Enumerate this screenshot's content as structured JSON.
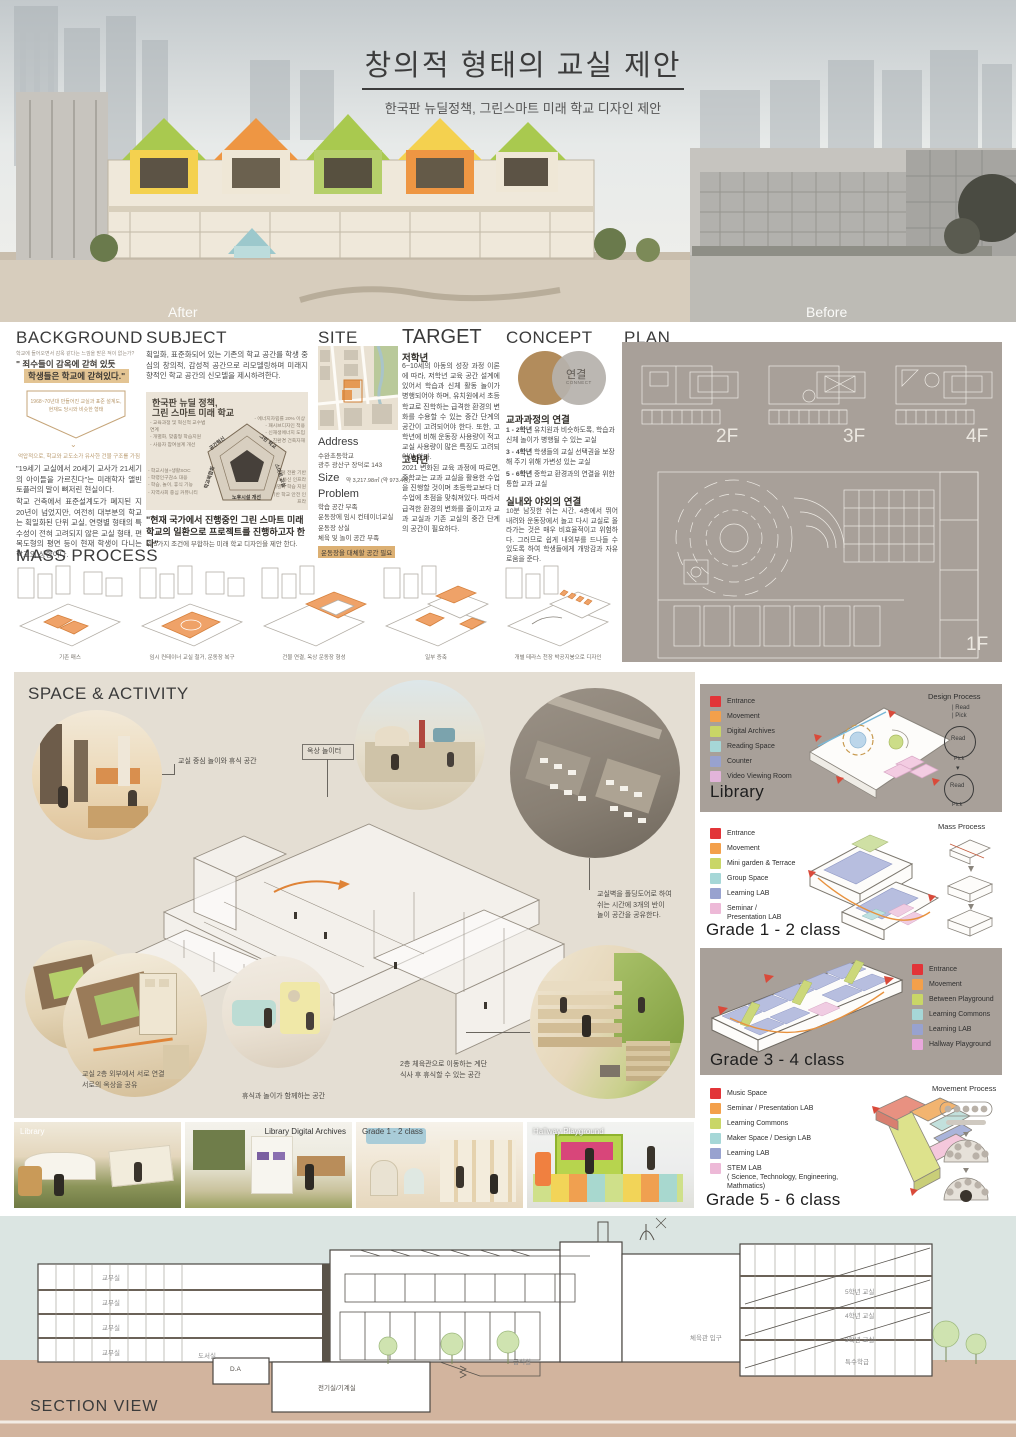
{
  "header": {
    "title": "창의적 형태의 교실 제안",
    "subtitle": "한국판 뉴딜정책, 그린스마트 미래 학교 디자인 제안",
    "after_label": "After",
    "before_label": "Before"
  },
  "background": {
    "heading": "BACKGROUND",
    "tagline": "학교에 들어오면서 감옥 같다는 느낌을 받은 적이 없는가?",
    "quote_line1": "\" 죄수들이 감옥에 갇혀 있듯",
    "quote_line2": "학생들은 학교에 갇혀있다.\"",
    "shield_line1": "1968~70년대 만들어진 교실과 표준 설계도,",
    "shield_line2": "현재도 당시와 비슷한 형태",
    "shield_caption": "억압적으로, 학교와 교도소가 유사한 건물 구조를 가짐",
    "para1": "\"19세기 교실에서 20세기 교사가 21세기의 아이들을 가르친다\"는 미래학자 앨빈 토플러의 말이 뼈저린 현실이다.",
    "para2": "학교 건축에서 표준설계도가 폐지된 지 20년이 넘었지만, 여전히 대부분의 학교는 획일화된 단위 교실, 연령별 형태의 특수성이 전혀 고려되지 않은 교실 형태, 편복도형의 평면 등이 현재 학생이 다니는 학교의 상황이다."
  },
  "subject": {
    "heading": "SUBJECT",
    "intro": "획일화, 표준화되어 있는 기존의 학교 공간를 학생 중심의 창의적, 감성적 공간으로 리모델링하며 미래지향적인 학교 공간의 신모델을 제시하려한다.",
    "diagram_title_line1": "한국판 뉴딜 정책,",
    "diagram_title_line2": "그린 스마트 미래 학교",
    "left_top": [
      "- 교육과정 및 혁신적 교수법 연계",
      "- 개별화, 맞춤형 학습지원",
      "- 사용자 참여설계 개선"
    ],
    "right_top": [
      "- 에너지자립률 20% 이상",
      "- 패시브디자인 적용",
      "- 신재생에너지 도입",
      "- 친환경 건축자재"
    ],
    "left_bottom": [
      "- 학교시설+생활SOC",
      "- 학령인구감소 대응",
      "- 학습, 놀이, 휴식 기능",
      "- 지역사회 중심 커뮤니티"
    ],
    "right_bottom": [
      "- 디지털 전환 기반",
      "- 정보통신 인프라",
      "- 개별화 학습 지원",
      "- 지능정보기반 학교 안전 인프라"
    ],
    "pentagon": [
      "공간혁신",
      "그린 학교",
      "스마트 교실",
      "노후시설 개선",
      "학교복합화"
    ],
    "statement": "\"현재 국가에서 진행중인 그린 스마트 미래학교의 일환으로 프로젝트를 진행하고자 한다\"",
    "statement_note": "위 5가지 조건에 부합하는 미래 학교 디자인을 제안 한다."
  },
  "site": {
    "heading": "SITE",
    "address_label": "Address",
    "address_line1": "수완초등학교",
    "address_line2": "광주 광산구 장덕로 143",
    "size_label": "Size",
    "size_value": "약 3,217.98㎡ (약 973.4평)",
    "problem_label": "Problem",
    "problems": [
      "학습 공간 부족",
      "운동장에 임시 컨테이너교실",
      "운동장 상실",
      "체육 및 놀이 공간 부족"
    ],
    "problem_highlight": "운동장을 대체할 공간 필요"
  },
  "target": {
    "heading": "TARGET",
    "low_label": "저학년",
    "low_text": "6~10세의 아동의 성장 과정 이론에 따라, 저학년 교육 공간 설계에 있어서 학습과 신체 활동 놀이가 병행되어야 하며, 유치원에서 초등학교로 진학하는 급격한 환경의 변화를 수용할 수 있는 중간 단계의 공간이 고려되어야 한다. 또한, 고학년에 비해 운동장 사용량이 적고 교실 사용량이 많은 특징도 고려되어야 한다.",
    "high_label": "고학년",
    "high_text": "2021 변화된 교육 과정에 따르면, 중학교는 교과 교실을 활용한 수업을 진행할 것이며 초등학교보다 더 수업에 초점을 맞춰져있다. 따라서 급격한 환경의 변화를 줄이고자 교과 교실과 기존 교실의 중간 단계의 공간이 필요하다."
  },
  "concept": {
    "heading": "CONCEPT",
    "venn_label": "연결",
    "venn_sublabel": "CONNECT",
    "curriculum_title": "교과과정의 연결",
    "items": [
      {
        "grade": "1 - 2학년",
        "text": "유치원과 비슷하도록, 학습과 신체 놀이가 병행될 수 있는 교실"
      },
      {
        "grade": "3 - 4학년",
        "text": "학생들의 교실 선택권을 보장해 주기 위해 가변성 있는 교실"
      },
      {
        "grade": "5 - 6학년",
        "text": "중학교 환경과의 연결을 위한 통합 교과 교실"
      }
    ],
    "inout_title": "실내와 야외의 연결",
    "inout_text": "10분 남짓한 쉬는 시간, 4층에서 뛰어 내려와 운동장에서 놀고 다시 교실로 올라가는 것은 매우 비효율적이고 위험하다. 그러므로 쉽게 내외부를 드나들 수 있도록 하여 학생들에게 개방감과 자유로움을 준다."
  },
  "plan": {
    "heading": "PLAN",
    "floors": [
      "2F",
      "3F",
      "4F",
      "1F"
    ]
  },
  "mass_process": {
    "heading": "MASS PROCESS",
    "steps": [
      "기존 매스",
      "임시 컨테이너 교실 철거, 운동장 복구",
      "건물 연결, 옥상 운동장 형성",
      "일부 증축",
      "개별 테라스 천장 박공지붕으로 디자인"
    ]
  },
  "space": {
    "heading": "SPACE & ACTIVITY",
    "c1": "교실 중심 놀이와 휴식 공간",
    "c2": "옥상 놀이터",
    "c3a": "교실벽을 폴딩도어로 하여",
    "c3b": "쉬는 시간에 3개의 반이",
    "c3c": "놀이 공간을 공유한다.",
    "c4a": "교실 2층 외부에서 서로 연결",
    "c4b": "서로의 옥상을 공유",
    "c5": "휴식과 놀이가 함께하는 공간",
    "c6a": "2층 체육관으로 이동하는 계단",
    "c6b": "식사 후 휴식할 수 있는 공간"
  },
  "library": {
    "title": "Library",
    "process_title": "Design Process",
    "read": "Read",
    "pick": "Pick",
    "legend": [
      {
        "label": "Entrance",
        "color": "#e23438"
      },
      {
        "label": "Movement",
        "color": "#f3a04b"
      },
      {
        "label": "Digital Archives",
        "color": "#c9d667"
      },
      {
        "label": "Reading Space",
        "color": "#a6d7d7"
      },
      {
        "label": "Counter",
        "color": "#98a2cf"
      },
      {
        "label": "Video Viewing Room",
        "color": "#e2b4da"
      }
    ]
  },
  "grade12": {
    "title": "Grade 1 - 2 class",
    "process_title": "Mass Process",
    "legend": [
      {
        "label": "Entrance",
        "color": "#e23438"
      },
      {
        "label": "Movement",
        "color": "#f3a04b"
      },
      {
        "label": "Mini garden & Terrace",
        "color": "#c9d667"
      },
      {
        "label": "Group Space",
        "color": "#a6d7d7"
      },
      {
        "label": "Learning LAB",
        "color": "#98a2cf"
      },
      {
        "label": "Seminar / Presentation LAB",
        "color": "#edb9d7"
      }
    ]
  },
  "grade34": {
    "title": "Grade 3 - 4 class",
    "legend": [
      {
        "label": "Entrance",
        "color": "#e23438"
      },
      {
        "label": "Movement",
        "color": "#f3a04b"
      },
      {
        "label": "Between Playground",
        "color": "#c9d667"
      },
      {
        "label": "Learning Commons",
        "color": "#a6d7d7"
      },
      {
        "label": "Learning LAB",
        "color": "#98a2cf"
      },
      {
        "label": "Hallway Playground",
        "color": "#e9a8dc"
      }
    ]
  },
  "grade56": {
    "title": "Grade 5 - 6 class",
    "process_title": "Movement Process",
    "legend": [
      {
        "label": "Music Space",
        "color": "#e23438"
      },
      {
        "label": "Seminar / Presentation LAB",
        "color": "#f3a04b"
      },
      {
        "label": "Learning Commons",
        "color": "#c9d667"
      },
      {
        "label": "Maker Space / Design LAB",
        "color": "#a6d7d7"
      },
      {
        "label": "Learning LAB",
        "color": "#98a2cf"
      },
      {
        "label": "STEM LAB",
        "color": "#edb9d7"
      }
    ],
    "stem_sub": "( Science, Technology, Engineering, Mathmatics)"
  },
  "photos": [
    {
      "label": "Library"
    },
    {
      "label": "Library Digital Archives"
    },
    {
      "label": "Grade 1 - 2 class"
    },
    {
      "label": "Hallway Playground"
    }
  ],
  "section": {
    "heading": "SECTION VIEW",
    "rooms": [
      "교무실",
      "교무실",
      "교무실",
      "교무실"
    ],
    "library_label": "도서실",
    "da_label": "D.A",
    "machine_label": "전기실/기계실",
    "cafeteria_label": "급식실",
    "gym_label": "체육관 입구",
    "right_rooms": [
      "5학년 교실",
      "4학년 교실",
      "3학년 교실",
      "특수학급"
    ]
  }
}
